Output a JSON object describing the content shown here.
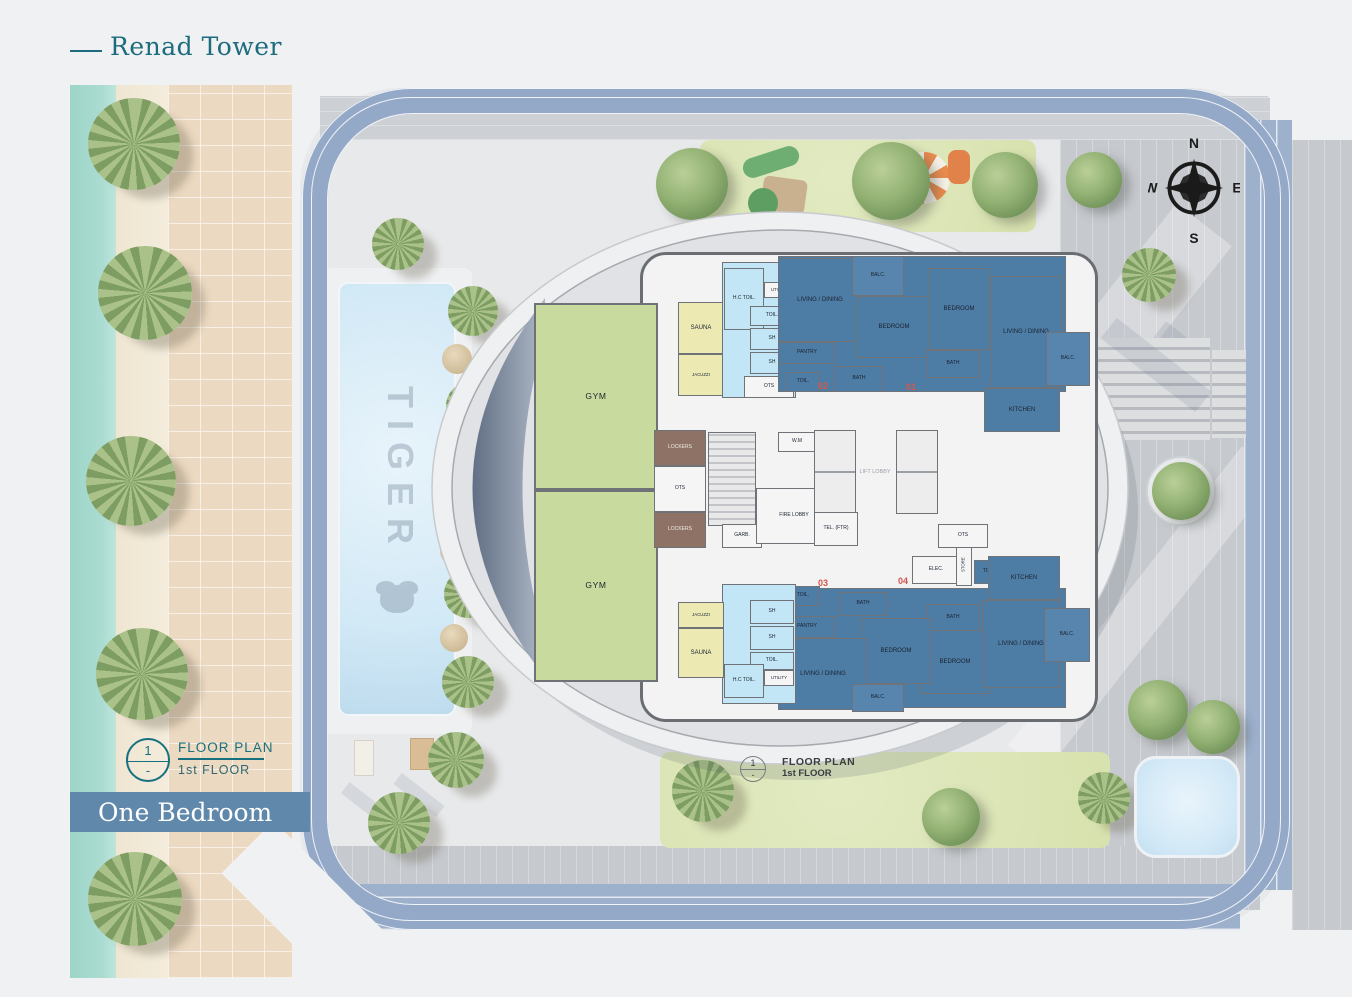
{
  "header": {
    "title": "Renad Tower"
  },
  "banner": {
    "title": "One Bedroom"
  },
  "legend": {
    "number": "1",
    "dash": "-",
    "title": "FLOOR PLAN",
    "subtitle": "1st FLOOR"
  },
  "plan_marker": {
    "number": "1",
    "dash": "-",
    "title": "FLOOR PLAN",
    "subtitle": "1st FLOOR"
  },
  "compass": {
    "north": "N",
    "east": "E",
    "south": "S",
    "west": "W"
  },
  "pool": {
    "watermark": "TIGER"
  },
  "units": {
    "u01": "01",
    "u02": "02",
    "u03": "03",
    "u04": "04"
  },
  "rooms": {
    "gym_top": "GYM",
    "gym_bottom": "GYM",
    "sauna_top": "SAUNA",
    "jacuzzi_top": "JACUZZI",
    "hc_toil_top": "H.C TOIL.",
    "utility_top": "UTILITY",
    "toil_top": "TOIL.",
    "sh_top_1": "SH",
    "sh_top_2": "SH",
    "ots_top": "OTS",
    "u02_living": "LIVING / DINING",
    "u02_balc": "BALC.",
    "u02_bedroom": "BEDROOM",
    "u02_pantry": "PANTRY",
    "u02_toil": "TOIL.",
    "u02_bath": "BATH",
    "u01_bedroom": "BEDROOM",
    "u01_bath": "BATH",
    "u01_living": "LIVING / DINING",
    "u01_balc": "BALC.",
    "u01_kitchen": "KITCHEN",
    "lockers_1": "LOCKERS",
    "ots_mid": "OTS",
    "lockers_2": "LOCKERS",
    "garb": "GARB.",
    "wm": "W.M",
    "fire_lobby": "FIRE LOBBY",
    "lift_lobby": "LIFT LOBBY",
    "tel_ftr": "TEL. (FTR)",
    "elec": "ELEC.",
    "store": "STORE",
    "ots_right": "OTS",
    "toil_right": "TOIL.",
    "u04_kitchen": "KITCHEN",
    "u04_bath": "BATH",
    "u04_bedroom": "BEDROOM",
    "u04_living": "LIVING / DINING",
    "u04_balc": "BALC.",
    "u03_toil": "TOIL.",
    "u03_bath": "BATH",
    "u03_pantry": "PANTRY",
    "u03_bedroom": "BEDROOM",
    "u03_living": "LIVING / DINING",
    "u03_balc": "BALC.",
    "sh_bot_1": "SH",
    "sh_bot_2": "SH",
    "toil_bot": "TOIL.",
    "hc_toil_bot": "H.C TOIL.",
    "utility_bot": "UTILITY",
    "jacuzzi_bot": "JACUZZI",
    "sauna_bot": "SAUNA"
  },
  "colors": {
    "brand_teal": "#1D6B7E",
    "banner_blue": "#5F88AB",
    "apartment_blue": "#4D7CA5",
    "gym_green": "#C9DA9F",
    "sauna_yellow": "#ECE9B3",
    "wet_area_blue": "#C2E6F5",
    "lockers_brown": "#8D7265",
    "unit_number_red": "#D4574A",
    "site_ring_blue": "#94A9C8"
  }
}
